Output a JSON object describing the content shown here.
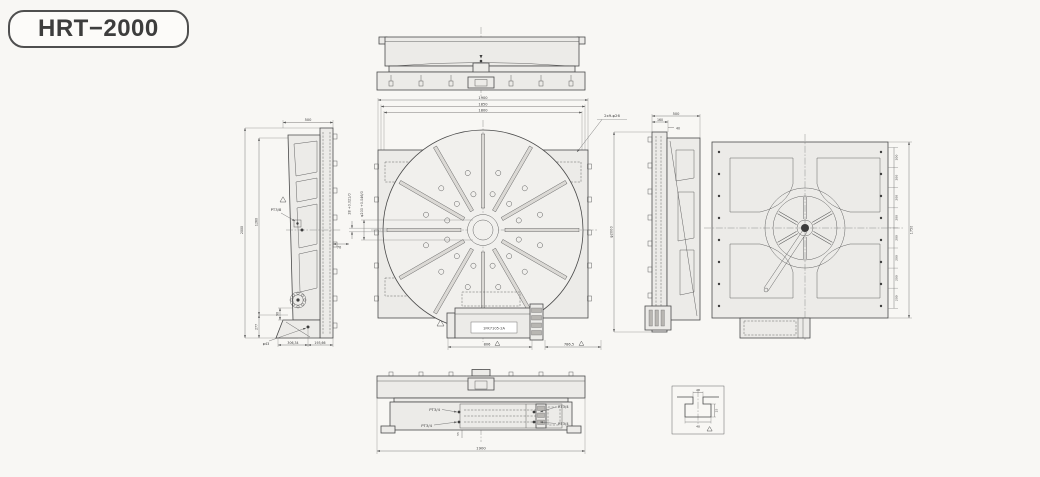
{
  "colors": {
    "background": "#f8f7f4",
    "ink": "#4a4a4a",
    "panel_fill": "#ecebe8",
    "face_fill": "#f1f0ed"
  },
  "title": {
    "label": "HRT−2000"
  },
  "front_view": {
    "dim_width_outer": "1900",
    "dim_width_mid": "1850",
    "dim_width_inner": "1800",
    "mount_holes_label": "2x9-φ26",
    "keyslot_dim": "28 +0.021/0",
    "bore_dim": "φ200 +0.046/0",
    "offset_dim": "70",
    "motor_label": "1FK7105-2A",
    "dim_motor": "806",
    "dim_right": "786,5"
  },
  "left_view": {
    "dim_width": "500",
    "dim_height_overall": "2000",
    "dim_height_upper": "1260",
    "dim_height_lower": "277",
    "dim_step": "90",
    "port_label": "PT3/8",
    "bolt_label": "φ43",
    "dim_foot_a": "306,34",
    "dim_foot_b": "193,66"
  },
  "right_view": {
    "dim_width": "500",
    "dim_a": "160",
    "dim_b": "40",
    "dia_label": "φ2000"
  },
  "back_view": {
    "pitch": "200",
    "dim_height": "1750"
  },
  "bottom_view": {
    "port_top_left": "PT3/4",
    "port_bottom_left": "PT3/4",
    "port_top_right": "PT3/4",
    "port_bottom_right": "PT3/4",
    "dim_overall": "1900",
    "dim_small": "55"
  },
  "detail_view": {
    "dim_top": "28",
    "dim_side": "25",
    "dim_bottom": "48"
  }
}
